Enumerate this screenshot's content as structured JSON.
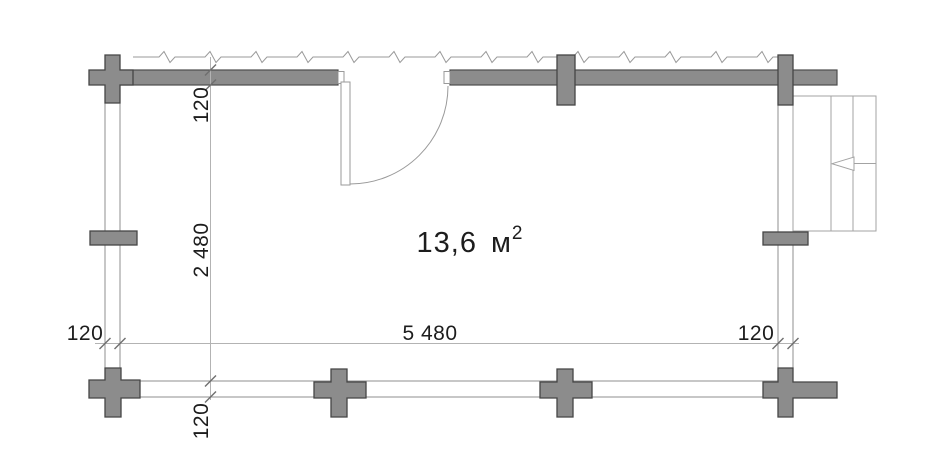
{
  "plan": {
    "area": {
      "value": "13,6",
      "unit": "м",
      "superscript": "2"
    },
    "dimensions": {
      "top_wall_thickness": "120",
      "interior_height": "2 480",
      "bottom_wall_thickness": "120",
      "left_wall_thickness": "120",
      "interior_width": "5 480",
      "right_wall_thickness": "120"
    },
    "colors": {
      "wall_fill": "#8c8c8c",
      "wall_outline": "#4c4c4c",
      "thin_line": "#9a9a9a",
      "dimension_line": "#b3b3b3",
      "text": "#1d1d1d",
      "background": "#ffffff"
    }
  }
}
